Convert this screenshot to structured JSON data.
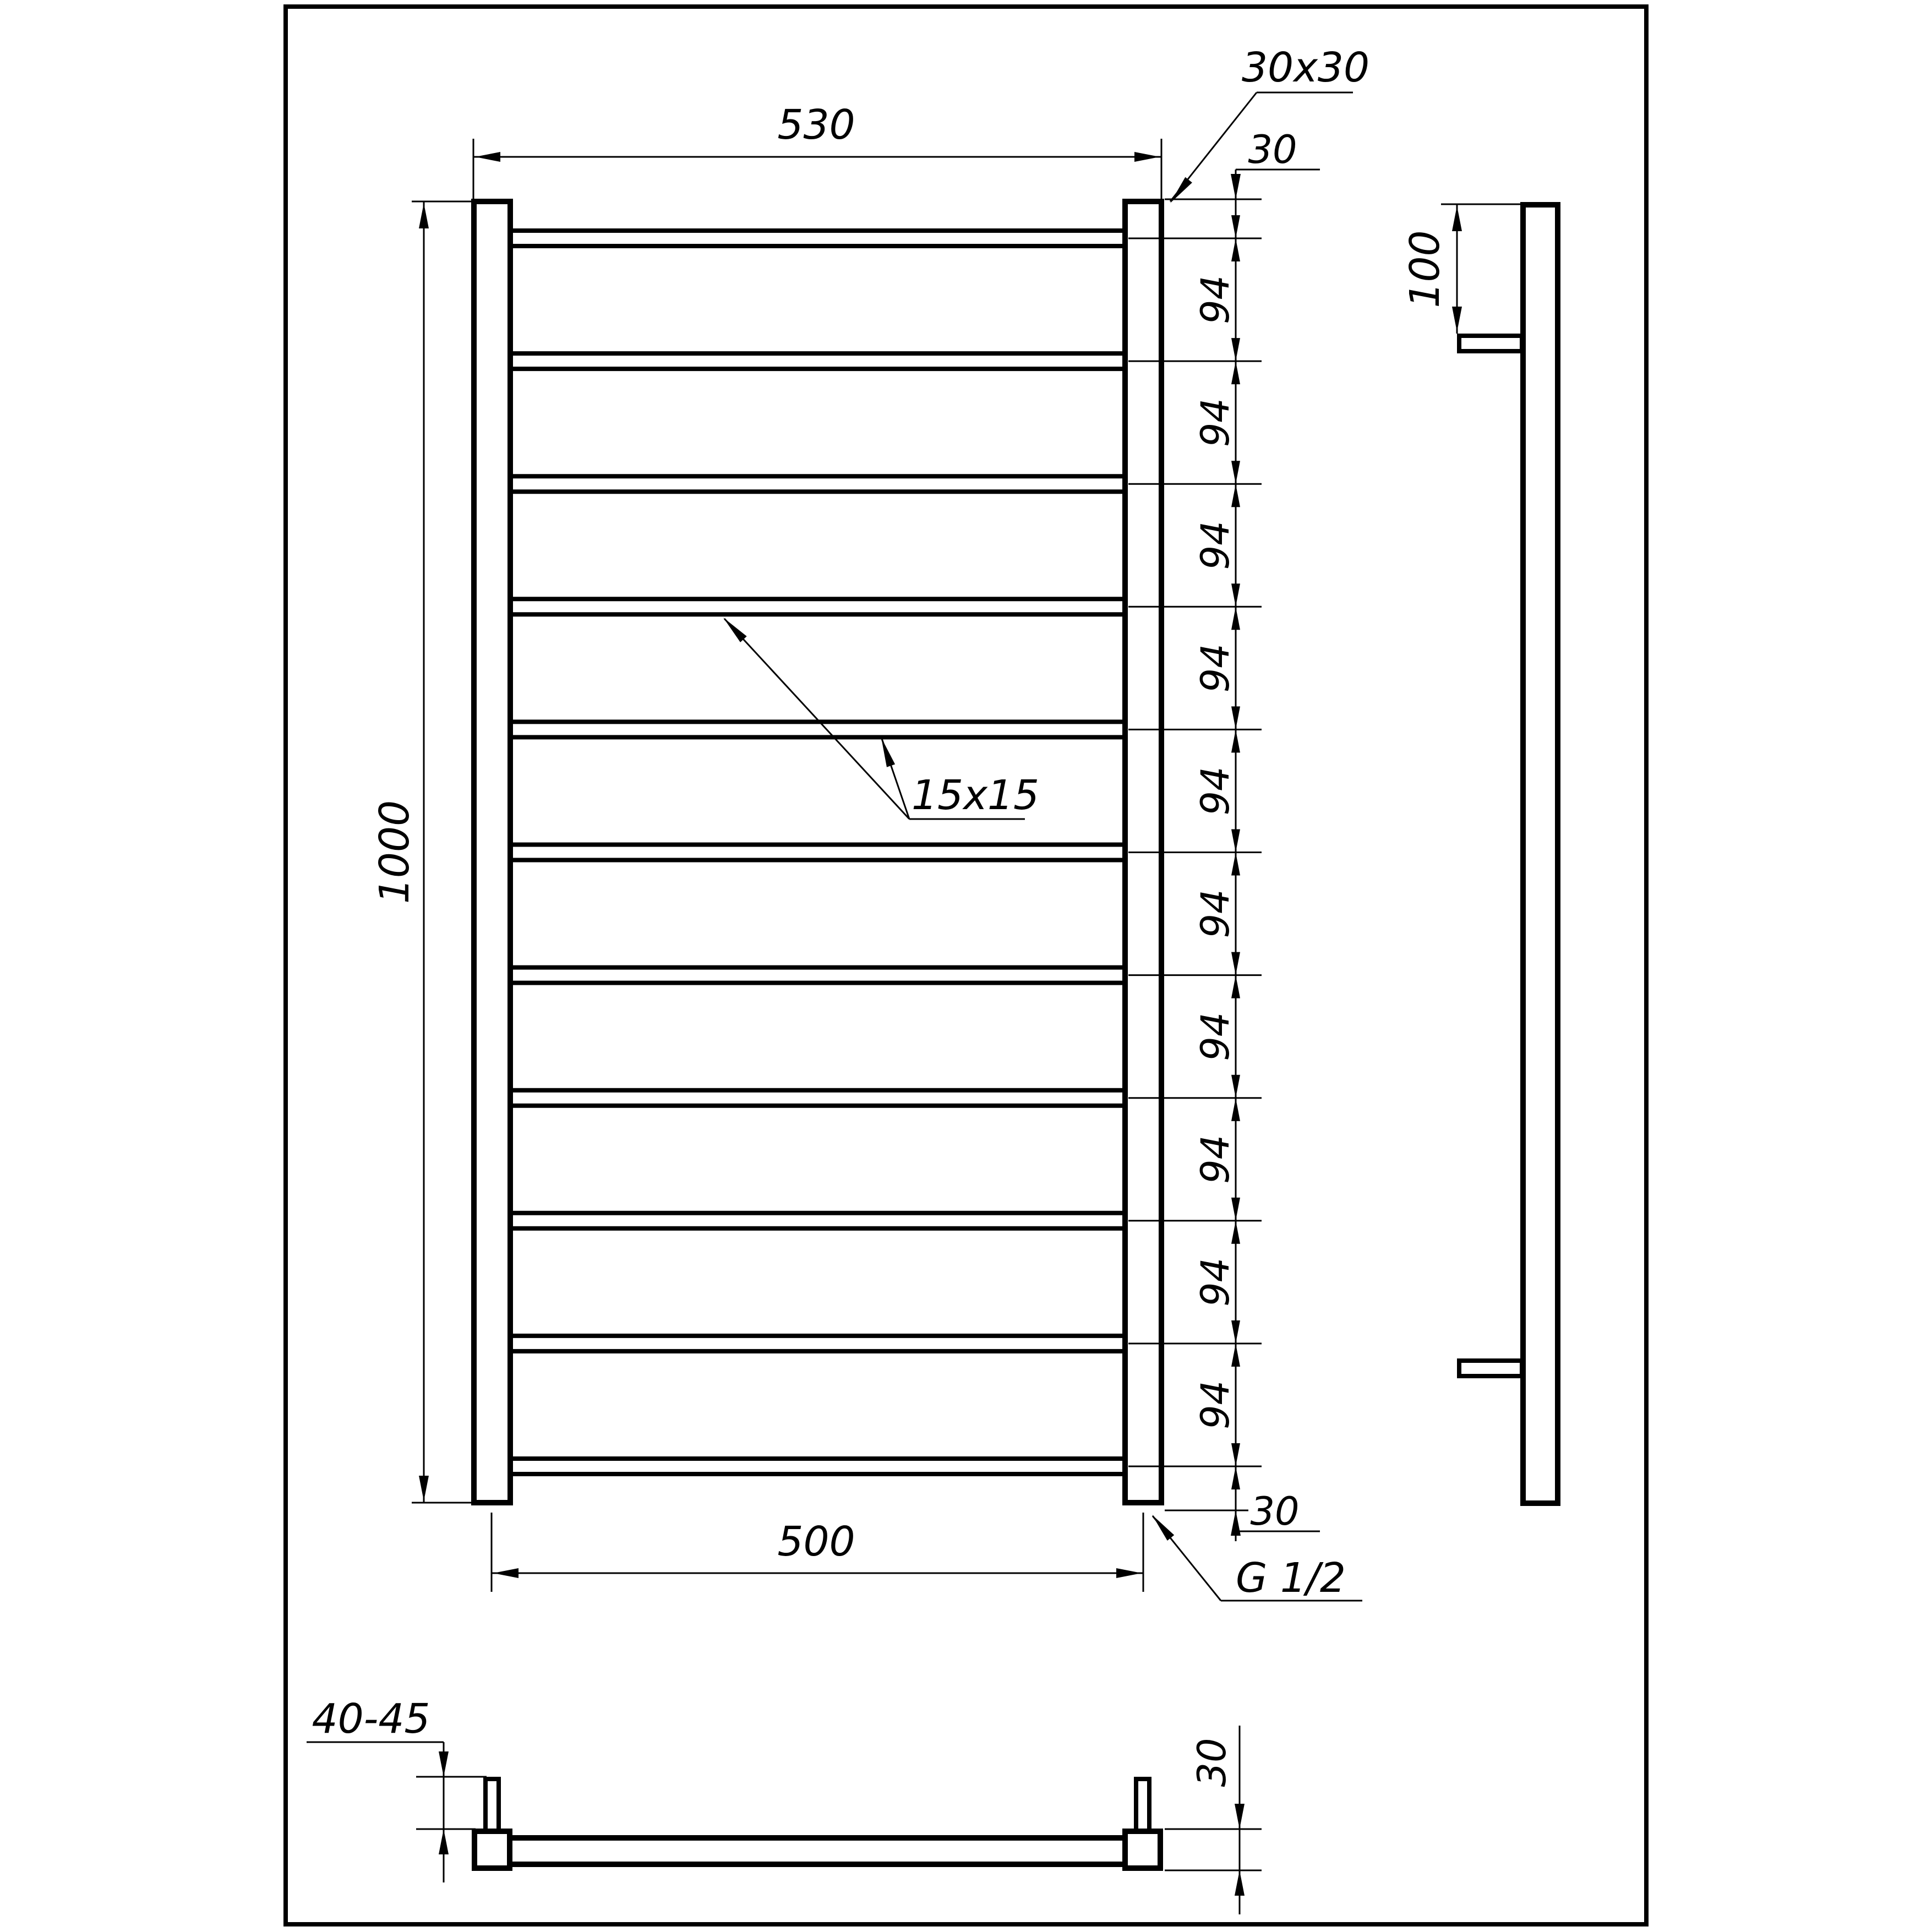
{
  "drawing": {
    "background_color": "#ffffff",
    "line_color": "#000000",
    "front_view": {
      "top_width": "530",
      "rail_section": "30x30",
      "top_offset": "30",
      "height": "1000",
      "rung_section": "15x15",
      "rung_spacings": [
        "94",
        "94",
        "94",
        "94",
        "94",
        "94",
        "94",
        "94",
        "94",
        "94"
      ],
      "bottom_offset": "30",
      "bottom_width": "500",
      "thread": "G 1/2"
    },
    "side_view": {
      "bracket_offset": "100"
    },
    "bottom_view": {
      "bracket_depth": "40-45",
      "tube_size": "30"
    }
  }
}
